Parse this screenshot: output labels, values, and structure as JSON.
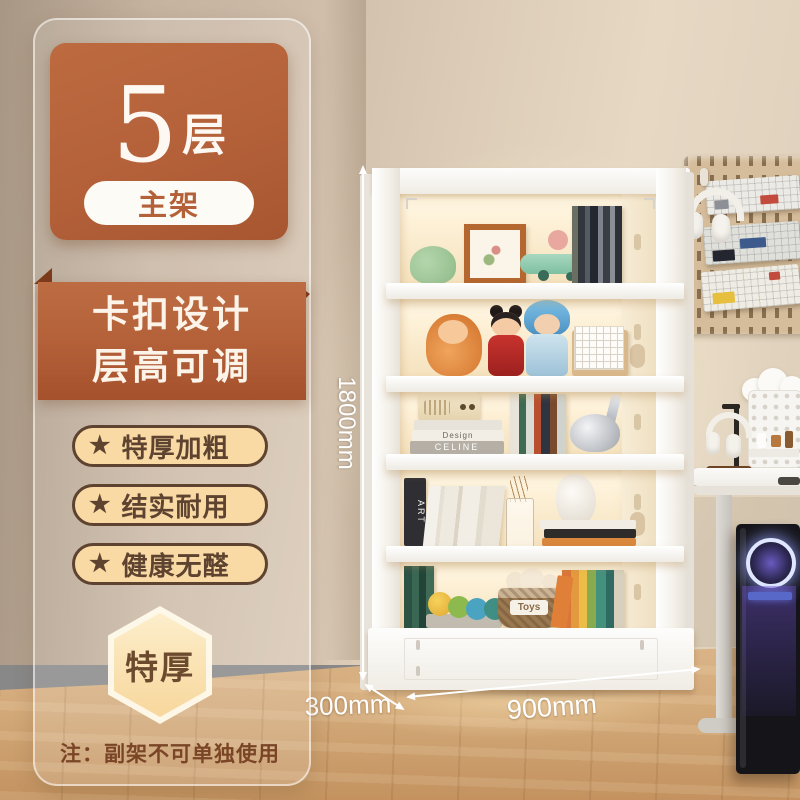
{
  "colors": {
    "accent": "#b4613a",
    "accent_dark": "#7d3b1c",
    "cream_pill": "#f9d9a4",
    "brown_text": "#5e4430",
    "hex_fill": "#f7d79c",
    "note_brown": "#7a4526",
    "dim_white": "#ffffff",
    "wall": "#cfbdab",
    "floor": "#d2a878",
    "shelf_white": "#f7f5f1"
  },
  "badge_card": {
    "number": "5",
    "unit": "层",
    "tag": "主架"
  },
  "ribbon": {
    "line1": "卡扣设计",
    "line2": "层高可调"
  },
  "features": [
    {
      "icon": "★",
      "label": "特厚加粗"
    },
    {
      "icon": "★",
      "label": "结实耐用"
    },
    {
      "icon": "★",
      "label": "健康无醛"
    }
  ],
  "hex_badge": {
    "label": "特厚"
  },
  "footnote": {
    "text": "注：副架不可单独使用"
  },
  "dimensions": {
    "height": "1800mm",
    "depth": "300mm",
    "width": "900mm"
  },
  "shelf_labels": {
    "design": "Design",
    "celine": "CELINE",
    "art": "ART",
    "toys": "Toys"
  },
  "scene": {
    "tiers": 5,
    "pegboard_keyboards": 3,
    "items": [
      "hanging-headphones",
      "mechanical-keyboards",
      "cloud-decor",
      "desk-organizer",
      "headphone-stand",
      "standing-desk",
      "pc-tower"
    ]
  }
}
